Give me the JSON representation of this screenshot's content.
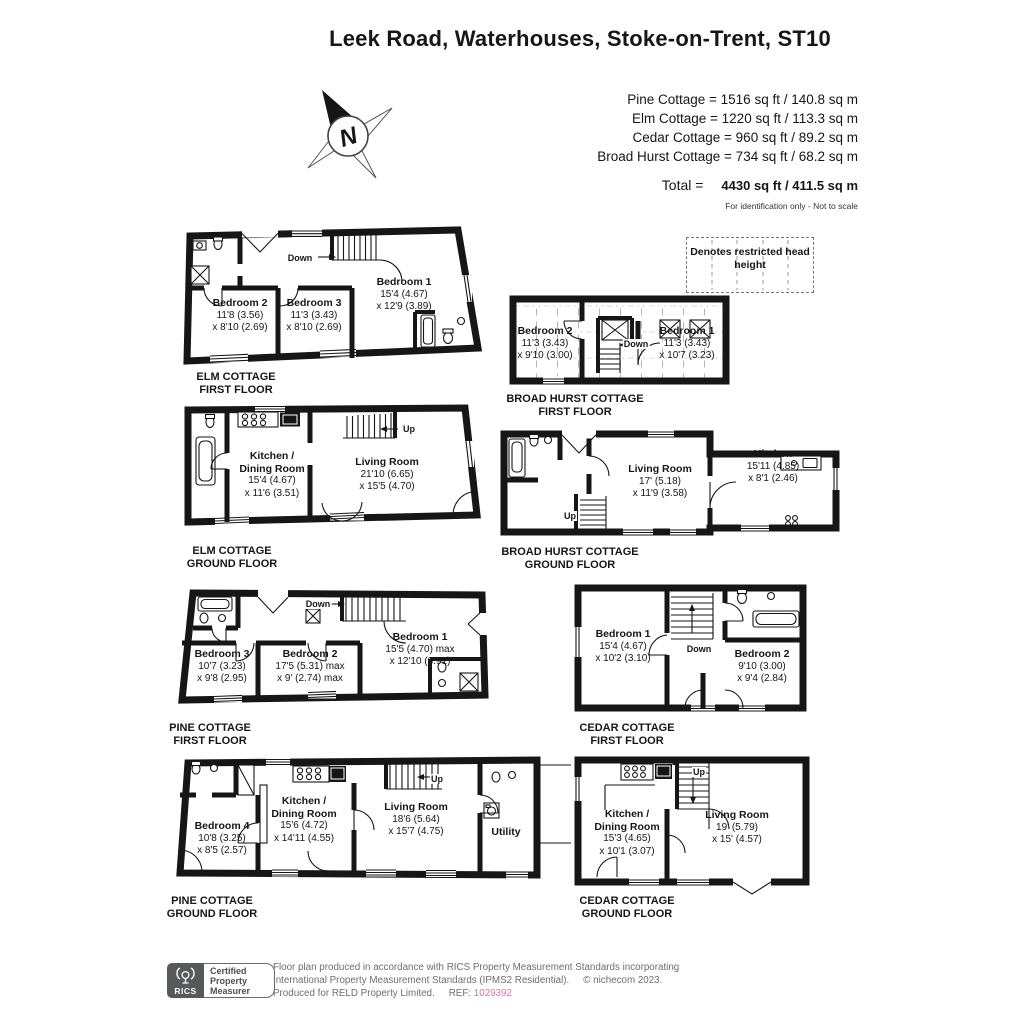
{
  "title": "Leek Road, Waterhouses, Stoke-on-Trent, ST10",
  "compass": {
    "label": "N"
  },
  "summary": {
    "lines": [
      "Pine Cottage = 1516 sq ft / 140.8 sq m",
      "Elm Cottage = 1220 sq ft / 113.3 sq m",
      "Cedar Cottage = 960 sq ft / 89.2 sq m",
      "Broad Hurst Cottage = 734 sq ft / 68.2 sq m"
    ],
    "total_label": "Total =",
    "total_value": "4430 sq ft / 411.5 sq m",
    "disclaimer": "For identification only - Not to scale"
  },
  "legend": {
    "restricted": "Denotes restricted head height"
  },
  "plans": {
    "elm_first": {
      "caption": [
        "ELM COTTAGE",
        "FIRST FLOOR"
      ],
      "stair": "Down",
      "rooms": [
        {
          "name": "Bedroom 2",
          "d1": "11'8 (3.56)",
          "d2": "x 8'10 (2.69)"
        },
        {
          "name": "Bedroom 3",
          "d1": "11'3 (3.43)",
          "d2": "x 8'10 (2.69)"
        },
        {
          "name": "Bedroom 1",
          "d1": "15'4 (4.67)",
          "d2": "x 12'9 (3.89)"
        }
      ]
    },
    "broadhurst_first": {
      "caption": [
        "BROAD HURST COTTAGE",
        "FIRST FLOOR"
      ],
      "stair": "Down",
      "rooms": [
        {
          "name": "Bedroom 2",
          "d1": "11'3 (3.43)",
          "d2": "x 9'10 (3.00)"
        },
        {
          "name": "Bedroom 1",
          "d1": "11'3 (3.43)",
          "d2": "x 10'7 (3.23)"
        }
      ]
    },
    "elm_ground": {
      "caption": [
        "ELM COTTAGE",
        "GROUND FLOOR"
      ],
      "stair": "Up",
      "rooms": [
        {
          "name": "Kitchen /",
          "name2": "Dining Room",
          "d1": "15'4 (4.67)",
          "d2": "x 11'6 (3.51)"
        },
        {
          "name": "Living Room",
          "d1": "21'10 (6.65)",
          "d2": "x 15'5 (4.70)"
        }
      ]
    },
    "broadhurst_ground": {
      "caption": [
        "BROAD HURST COTTAGE",
        "GROUND FLOOR"
      ],
      "stair": "Up",
      "rooms": [
        {
          "name": "Living Room",
          "d1": "17' (5.18)",
          "d2": "x 11'9 (3.58)"
        },
        {
          "name": "Kitchen",
          "d1": "15'11 (4.85)",
          "d2": "x 8'1 (2.46)"
        }
      ]
    },
    "pine_first": {
      "caption": [
        "PINE COTTAGE",
        "FIRST FLOOR"
      ],
      "stair": "Down",
      "rooms": [
        {
          "name": "Bedroom 3",
          "d1": "10'7 (3.23)",
          "d2": "x 9'8 (2.95)"
        },
        {
          "name": "Bedroom 2",
          "d1": "17'5 (5.31) max",
          "d2": "x 9' (2.74) max"
        },
        {
          "name": "Bedroom 1",
          "d1": "15'5 (4.70) max",
          "d2": "x 12'10 (3.91)"
        }
      ]
    },
    "cedar_first": {
      "caption": [
        "CEDAR COTTAGE",
        "FIRST FLOOR"
      ],
      "stair": "Down",
      "rooms": [
        {
          "name": "Bedroom 1",
          "d1": "15'4 (4.67)",
          "d2": "x 10'2 (3.10)"
        },
        {
          "name": "Bedroom 2",
          "d1": "9'10 (3.00)",
          "d2": "x 9'4 (2.84)"
        }
      ]
    },
    "pine_ground": {
      "caption": [
        "PINE COTTAGE",
        "GROUND FLOOR"
      ],
      "stair": "Up",
      "rooms": [
        {
          "name": "Bedroom 4",
          "d1": "10'8 (3.25)",
          "d2": "x 8'5 (2.57)"
        },
        {
          "name": "Kitchen /",
          "name2": "Dining Room",
          "d1": "15'6 (4.72)",
          "d2": "x 14'11 (4.55)"
        },
        {
          "name": "Living Room",
          "d1": "18'6 (5.64)",
          "d2": "x 15'7 (4.75)"
        },
        {
          "name": "Utility"
        }
      ]
    },
    "cedar_ground": {
      "caption": [
        "CEDAR COTTAGE",
        "GROUND FLOOR"
      ],
      "stair": "Up",
      "rooms": [
        {
          "name": "Kitchen /",
          "name2": "Dining Room",
          "d1": "15'3 (4.65)",
          "d2": "x 10'1 (3.07)"
        },
        {
          "name": "Living Room",
          "d1": "19' (5.79)",
          "d2": "x 15' (4.57)"
        }
      ]
    }
  },
  "footer": {
    "rics": "RICS",
    "cert": [
      "Certified",
      "Property",
      "Measurer"
    ],
    "line1": "Floor plan produced in accordance with RICS Property Measurement Standards incorporating",
    "line2": "International Property Measurement Standards (IPMS2 Residential).",
    "copyright": "© nichecom 2023.",
    "line3": "Produced for RELD Property Limited.",
    "ref_label": "REF:",
    "ref": "1029392"
  },
  "colors": {
    "wall": "#161616",
    "footer_gray": "#6d6e71",
    "ref_pink": "#d873ae",
    "logo_gray": "#58595b"
  },
  "icons": {
    "compass": "compass-north-icon",
    "logo": "rics-lyre-icon"
  }
}
